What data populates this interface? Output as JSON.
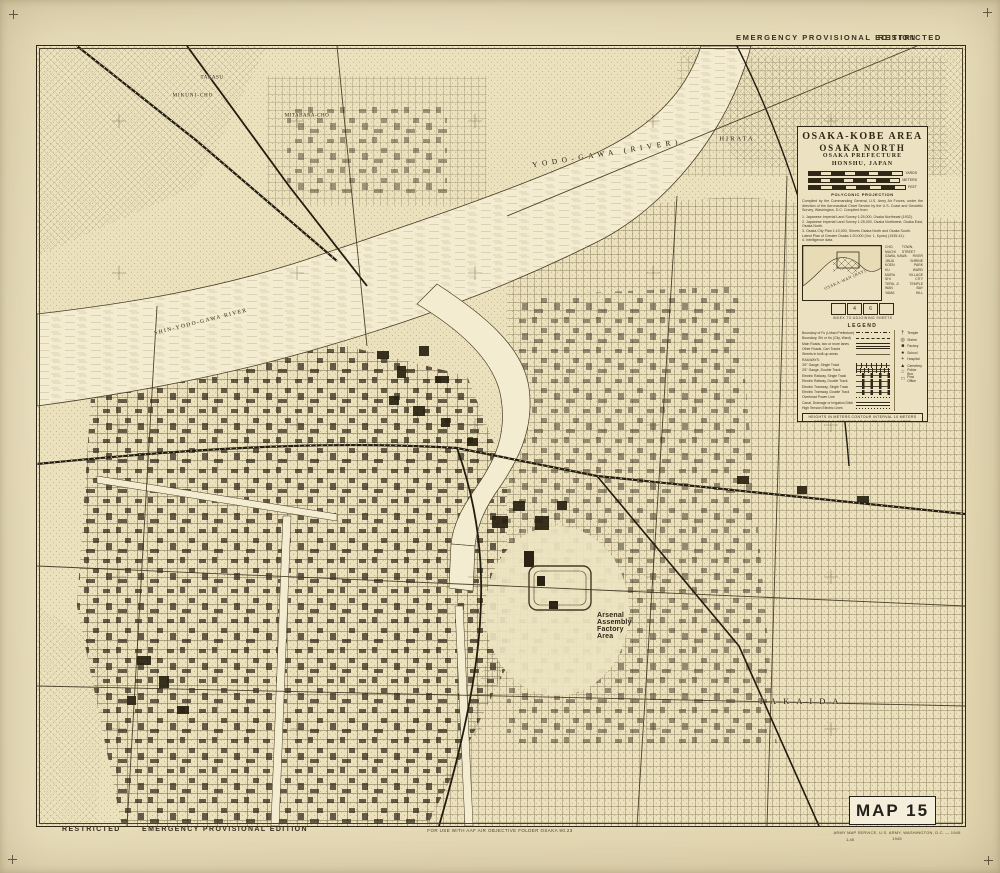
{
  "colors": {
    "paper": "#eadfbb",
    "ink": "#2f2817",
    "water": "#f4ecd1"
  },
  "header": {
    "edition": "EMERGENCY PROVISIONAL EDITION",
    "classification": "RESTRICTED"
  },
  "footer": {
    "classification": "RESTRICTED",
    "edition": "EMERGENCY PROVISIONAL EDITION",
    "use_note": "FOR USE WITH AAF AIR OBJECTIVE FOLDER OSAKA 90.23",
    "agency_line": "ARMY MAP SERVICE, U.S. ARMY, WASHINGTON, D.C. — 1945",
    "print_year": "1945",
    "print_code": "1-45"
  },
  "map_number": "MAP 15",
  "title_block": {
    "title1": "OSAKA-KOBE AREA",
    "title2": "OSAKA NORTH",
    "title3": "OSAKA PREFECTURE",
    "title4": "HONSHU, JAPAN",
    "projection": "POLYCONIC PROJECTION",
    "credit": "Compiled by the Commanding General, U.S. Army Air Forces, under the direction of the Aeronautical Chart Service by the U.S. Coast and Geodetic Survey, Washington, D.C. Compiled from:",
    "sources": [
      "1. Japanese Imperial Land Survey 1:25,000, Osaka Northeast (1932).",
      "2. Japanese Imperial Land Survey 1:25,000, Osaka Northwest, Osaka East, Osaka North.",
      "3. Osaka City Plan 1:10,000, Sheets Osaka North and Osaka South.",
      "Latest Plan of Greater Osaka 1:20,000 (Vol. 1, Kyoto) (1935-41).",
      "4. Intelligence data."
    ],
    "scale_units": [
      "YARDS",
      "METERS",
      "FEET"
    ]
  },
  "inset": {
    "bay_label": "OSAKA-WAN (BAY)",
    "caption": "INDEX TO ADJOINING SHEETS",
    "sheets": [
      "",
      "4",
      "6",
      ""
    ]
  },
  "glossary": [
    [
      "CHO, MACHI",
      "TOWN, STREET"
    ],
    [
      "GAWA, KAWA",
      "RIVER"
    ],
    [
      "JINJA",
      "SHRINE"
    ],
    [
      "KOEN",
      "PARK"
    ],
    [
      "KU",
      "WARD"
    ],
    [
      "MURA",
      "VILLAGE"
    ],
    [
      "SHI",
      "CITY"
    ],
    [
      "TERA, JI",
      "TEMPLE"
    ],
    [
      "WAN",
      "BAY"
    ],
    [
      "YAMA",
      "HILL"
    ]
  ],
  "legend": {
    "title": "LEGEND",
    "items": [
      {
        "label": "Boundary of Fu (Urban Prefecture)",
        "sym": "dashdot"
      },
      {
        "label": "Boundary, Shi or Ku (City, Ward)",
        "sym": "dash"
      },
      {
        "label": "Main Roads, two or more lanes",
        "sym": "double"
      },
      {
        "label": "Other Roads, Cart Tracks",
        "sym": "single"
      },
      {
        "label": "Streets in built-up areas",
        "sym": "thin"
      },
      {
        "label": "RAILWAYS:",
        "sym": "none"
      },
      {
        "label": "3'6\" Gauge, Single Track",
        "sym": "rail1"
      },
      {
        "label": "3'6\" Gauge, Double Track",
        "sym": "rail2"
      },
      {
        "label": "Electric Railway, Single Track",
        "sym": "erail"
      },
      {
        "label": "Electric Railway, Double Track",
        "sym": "erail"
      },
      {
        "label": "Electric Tramway, Single Track",
        "sym": "erail"
      },
      {
        "label": "Electric Tramway, Double Track",
        "sym": "erail"
      },
      {
        "label": "Overhead Power Line",
        "sym": "power"
      },
      {
        "label": "Canal, Drainage or Irrigation Ditch",
        "sym": "canal"
      },
      {
        "label": "High Tension Electric Lines",
        "sym": "power"
      }
    ],
    "side_items": [
      {
        "glyph": "†",
        "label": "Temple"
      },
      {
        "glyph": "◎",
        "label": "Shrine"
      },
      {
        "glyph": "■",
        "label": "Factory"
      },
      {
        "glyph": "●",
        "label": "School"
      },
      {
        "glyph": "+",
        "label": "Hospital"
      },
      {
        "glyph": "▲",
        "label": "Cemetery"
      },
      {
        "glyph": "☆",
        "label": "Police Box"
      },
      {
        "glyph": "□",
        "label": "Post Office"
      }
    ],
    "note1": "HEIGHTS IN METERS  CONTOUR INTERVAL 10 METERS",
    "note2": "DEPTHS IN FATHOMS AT CHART LOWEST WATER"
  },
  "map_labels": [
    {
      "id": "yodo-gawa-river",
      "text": "YODO-GAWA  (RIVER)",
      "x": 607,
      "y": 153,
      "rot": -9,
      "size": 7.5,
      "ls": 4.5,
      "sans": false
    },
    {
      "id": "hirata",
      "text": "HIRATA",
      "x": 737,
      "y": 139,
      "rot": 0,
      "size": 6.5,
      "ls": 2,
      "sans": false
    },
    {
      "id": "shin-yodo-gawa-river",
      "text": "SHIN-YODO-GAWA  RIVER",
      "x": 201,
      "y": 322,
      "rot": -14,
      "size": 5.5,
      "ls": 1.5,
      "sans": false
    },
    {
      "id": "arsenal-area",
      "text": "Arsenal\nAssembly\nFactory\nArea",
      "x": 597,
      "y": 612,
      "rot": 0,
      "size": 7,
      "ls": 0.2,
      "sans": true,
      "align": "left"
    },
    {
      "id": "takaida",
      "text": "TAKAIDA",
      "x": 802,
      "y": 701,
      "rot": 0,
      "size": 8.5,
      "ls": 7,
      "sans": false
    },
    {
      "id": "mikuni-cho",
      "text": "MIKUNI-CHO",
      "x": 193,
      "y": 96,
      "rot": 0,
      "size": 5,
      "ls": 1,
      "sans": false
    },
    {
      "id": "takasu",
      "text": "TAKASU",
      "x": 212,
      "y": 78,
      "rot": 0,
      "size": 5,
      "ls": 0.5,
      "sans": false
    },
    {
      "id": "mitabara-cho",
      "text": "MITABARA-CHO",
      "x": 307,
      "y": 116,
      "rot": 0,
      "size": 5,
      "ls": 0.5,
      "sans": false
    }
  ]
}
